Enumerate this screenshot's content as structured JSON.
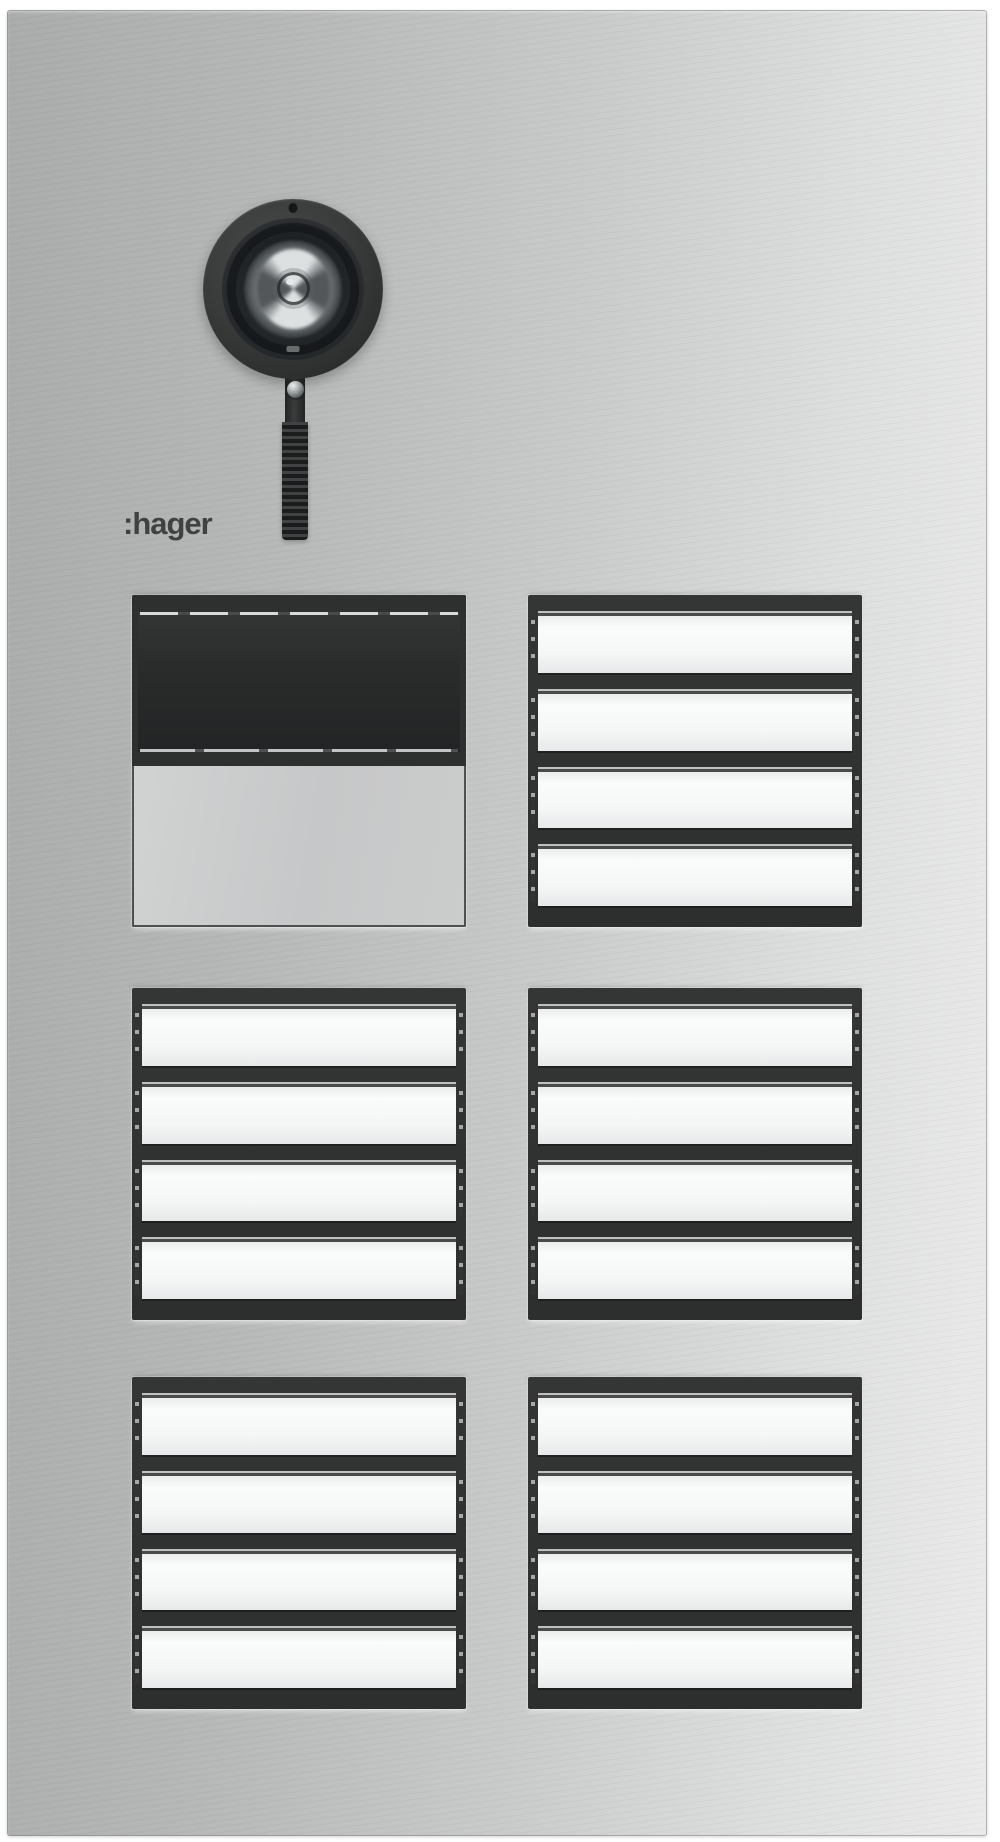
{
  "logo": {
    "text": ":hager"
  },
  "camera": {
    "type": "dome-camera-on-ribbed-stalk"
  },
  "modules": [
    {
      "type": "speaker-display-module",
      "display_text": "",
      "plate_text": ""
    },
    {
      "type": "call-button-module",
      "buttons": [
        {
          "label": ""
        },
        {
          "label": ""
        },
        {
          "label": ""
        },
        {
          "label": ""
        }
      ]
    },
    {
      "type": "call-button-module",
      "buttons": [
        {
          "label": ""
        },
        {
          "label": ""
        },
        {
          "label": ""
        },
        {
          "label": ""
        }
      ]
    },
    {
      "type": "call-button-module",
      "buttons": [
        {
          "label": ""
        },
        {
          "label": ""
        },
        {
          "label": ""
        },
        {
          "label": ""
        }
      ]
    },
    {
      "type": "call-button-module",
      "buttons": [
        {
          "label": ""
        },
        {
          "label": ""
        },
        {
          "label": ""
        },
        {
          "label": ""
        }
      ]
    },
    {
      "type": "call-button-module",
      "buttons": [
        {
          "label": ""
        },
        {
          "label": ""
        },
        {
          "label": ""
        },
        {
          "label": ""
        }
      ]
    }
  ],
  "colors": {
    "background": "#ffffff",
    "panel_gradient_left": "#aaacac",
    "panel_gradient_right": "#eaeaea",
    "module_frame": "#2e2f2f",
    "nameplate": "#f5f6f6",
    "speaker_window": "#2a2b2b",
    "camera_body": "#3a3c3c",
    "screw_ball": "#a2a7a8",
    "logo_color": "#404242"
  }
}
